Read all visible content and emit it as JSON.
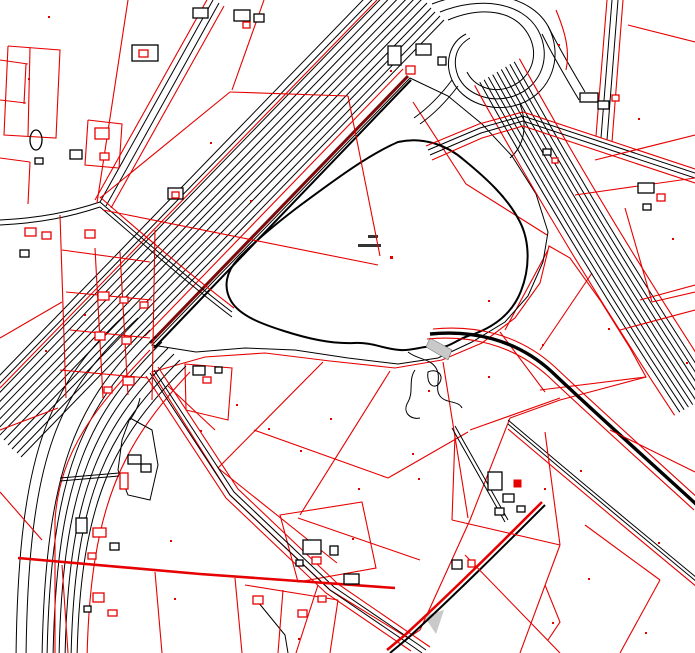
{
  "map": {
    "colors": {
      "background": "#ffffff",
      "water": "#aed0e3",
      "vegetation": "#56a42e",
      "field": "#eef0da",
      "parcel": "#e60000",
      "road": "#000000",
      "border": "#7d0a0a",
      "wetland": "#c9c9c9",
      "label": "#333333"
    },
    "features": [
      {
        "id": "lake",
        "kind": "water-body"
      },
      {
        "id": "vegetation-buffer",
        "kind": "green-area-around-lake"
      },
      {
        "id": "field-parcels",
        "kind": "cultivated-area"
      },
      {
        "id": "motorway-southwest",
        "kind": "multi-lane-road"
      },
      {
        "id": "motorway-east",
        "kind": "multi-lane-road"
      },
      {
        "id": "interchange-loop",
        "kind": "road-ramp"
      },
      {
        "id": "secondary-roads",
        "kind": "road"
      },
      {
        "id": "cadastral-parcel-boundaries",
        "kind": "boundary-lines"
      },
      {
        "id": "buildings",
        "kind": "structures"
      },
      {
        "id": "wetland-margin",
        "kind": "marsh-detail"
      }
    ]
  }
}
